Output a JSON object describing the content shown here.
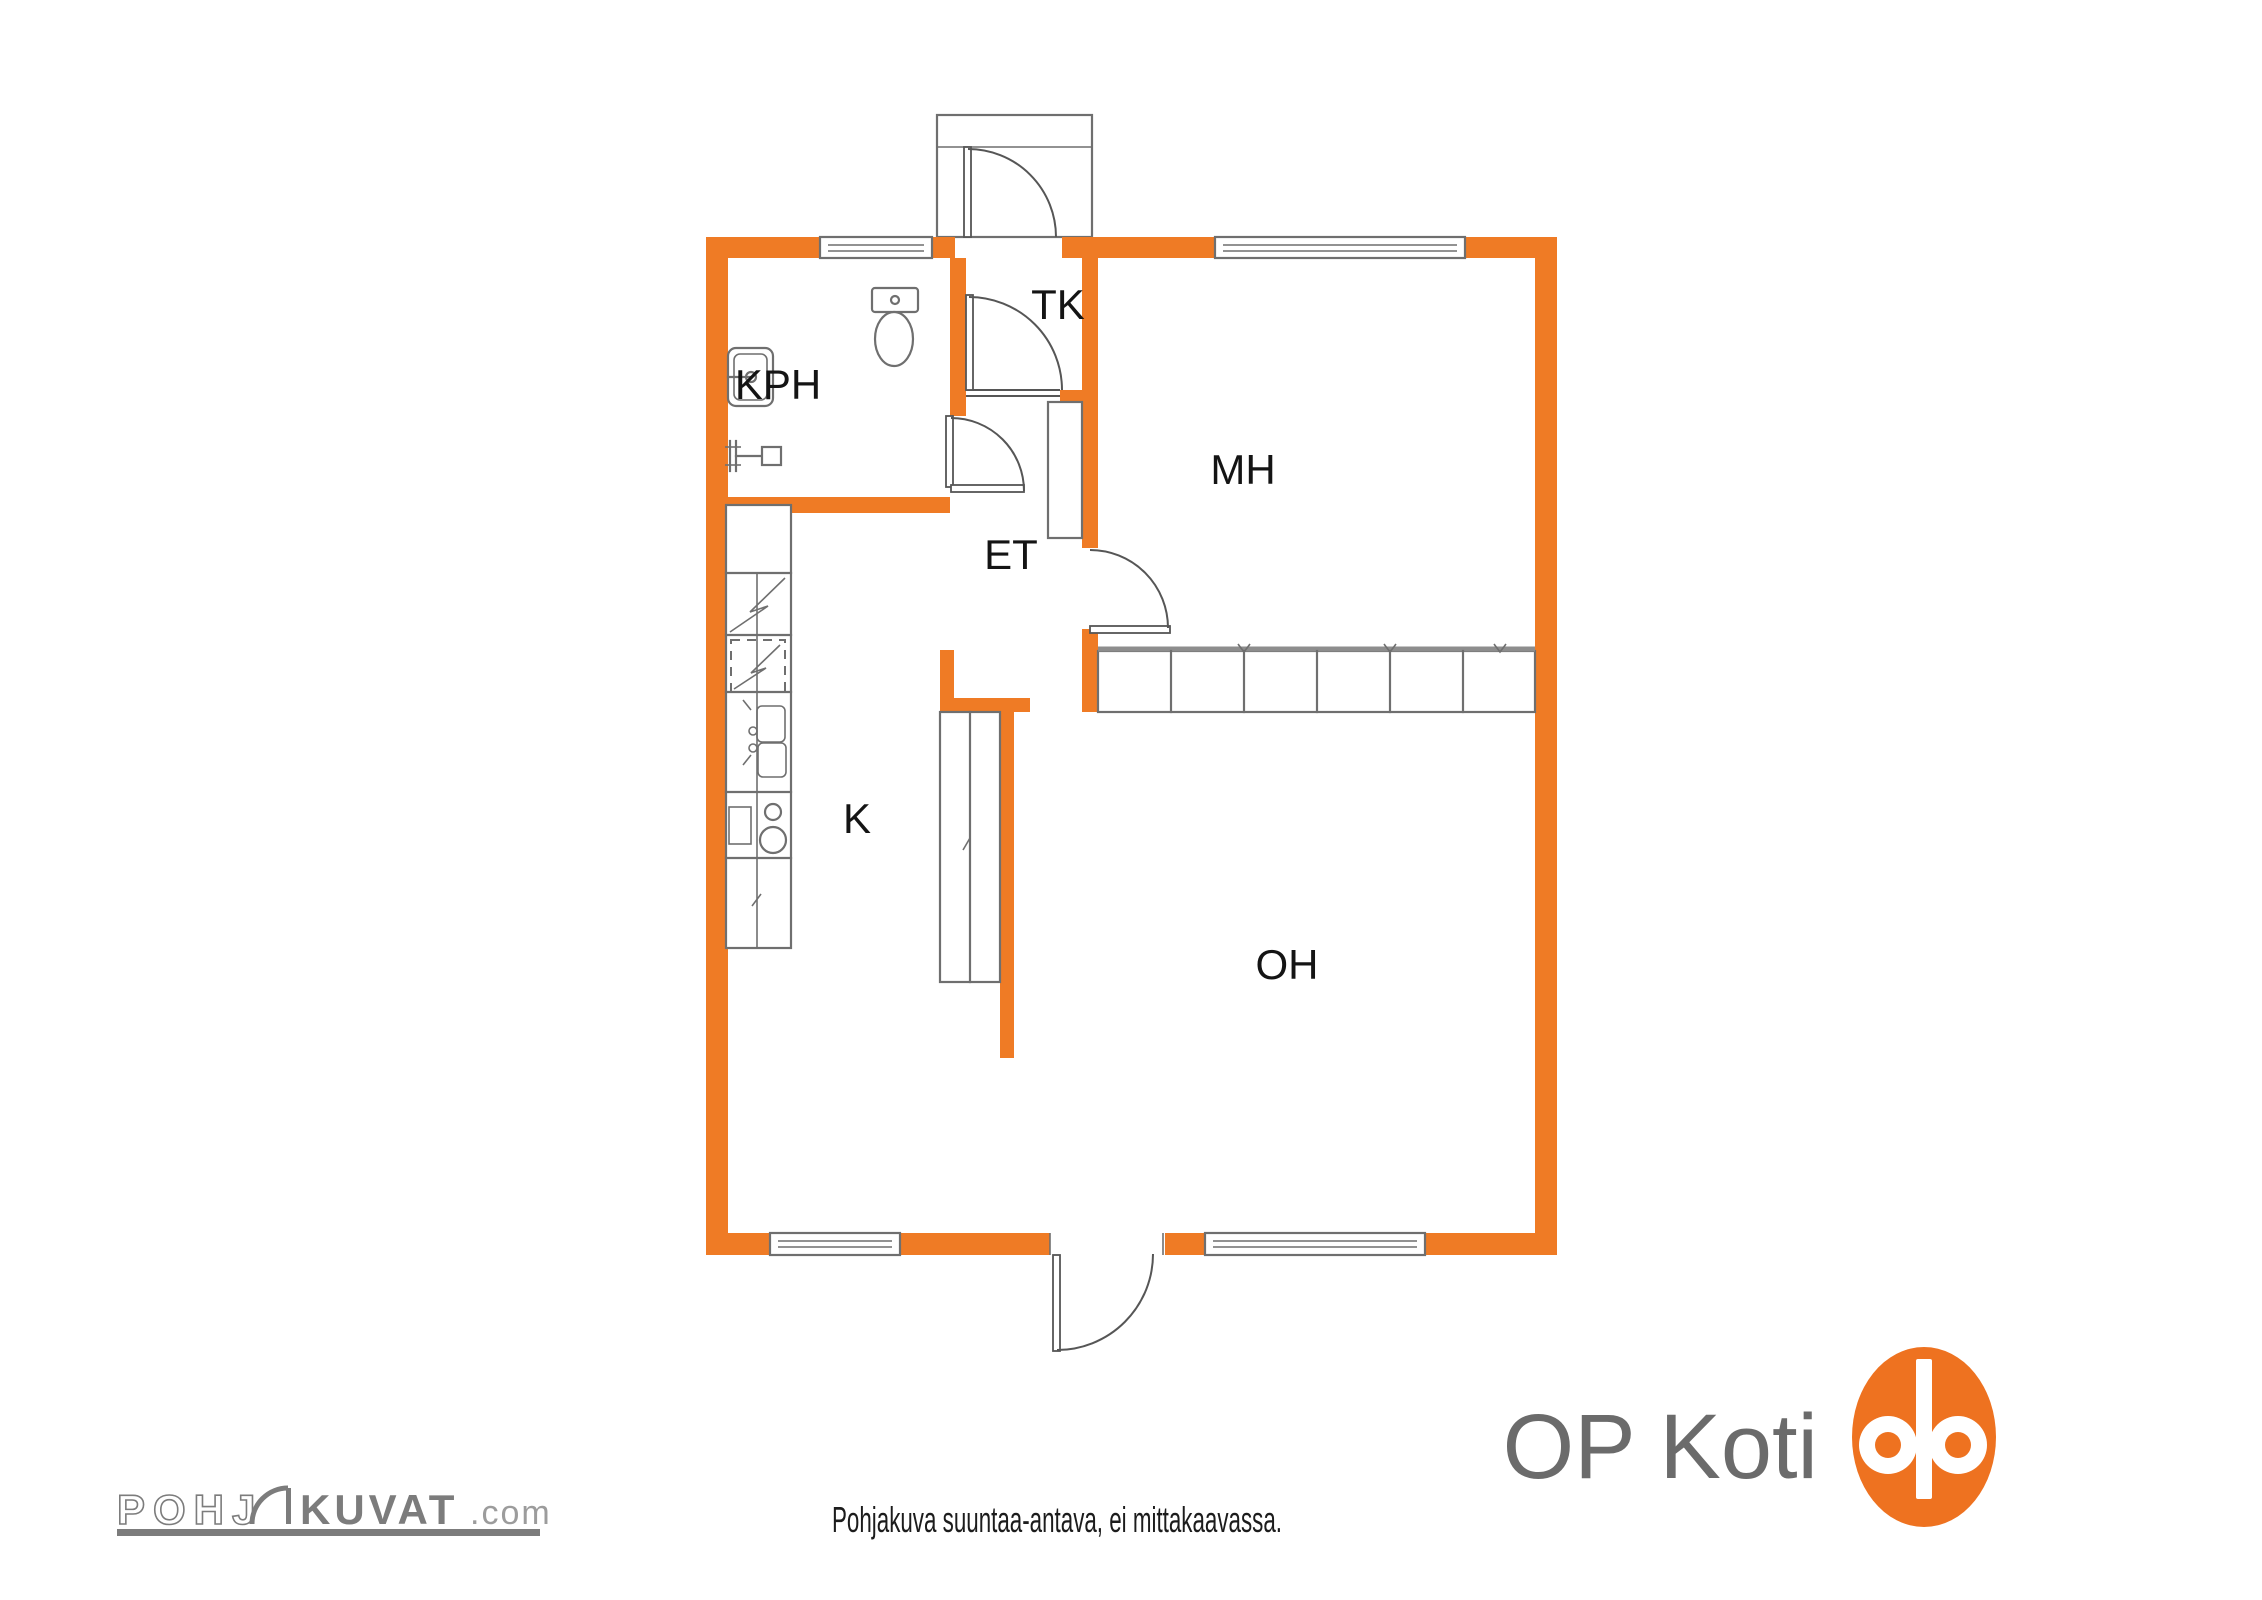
{
  "plan": {
    "rooms": [
      {
        "id": "kph",
        "label": "KPH"
      },
      {
        "id": "tk",
        "label": "TK"
      },
      {
        "id": "et",
        "label": "ET"
      },
      {
        "id": "mh",
        "label": "MH"
      },
      {
        "id": "k",
        "label": "K"
      },
      {
        "id": "oh",
        "label": "OH"
      }
    ],
    "doors": [
      "entrance-door",
      "tk-door",
      "kph-door",
      "mh-door",
      "balcony-door"
    ],
    "windows": [
      "kph-window",
      "mh-window",
      "kitchen-window",
      "oh-window"
    ],
    "fixtures": [
      "toilet",
      "washbasin",
      "shower-valve",
      "entrance-vestibule",
      "hall-wardrobe",
      "closet-row",
      "tall-cabinet",
      "upper-cabinet",
      "refrigerator",
      "appliance-reservation",
      "kitchen-sink",
      "stove",
      "base-cabinet"
    ]
  },
  "footer": {
    "disclaimer": "Pohjakuva suuntaa-antava, ei mittakaavassa."
  },
  "branding": {
    "op_koti_text": "OP Koti",
    "op_logo_icon": "op-monogram",
    "pohjakuvat": {
      "prefix": "POHJ",
      "door_icon": "door-arc",
      "main": "KUVAT",
      "suffix": ".com"
    }
  },
  "colors": {
    "wall_orange": "#EF7B25",
    "logo_orange": "#EE7220",
    "line_gray": "#6F6F6F",
    "door_gray": "#565656",
    "label_black": "#141414",
    "brand_gray": "#6B6B6B",
    "pk_gray": "#7C7C7C"
  }
}
